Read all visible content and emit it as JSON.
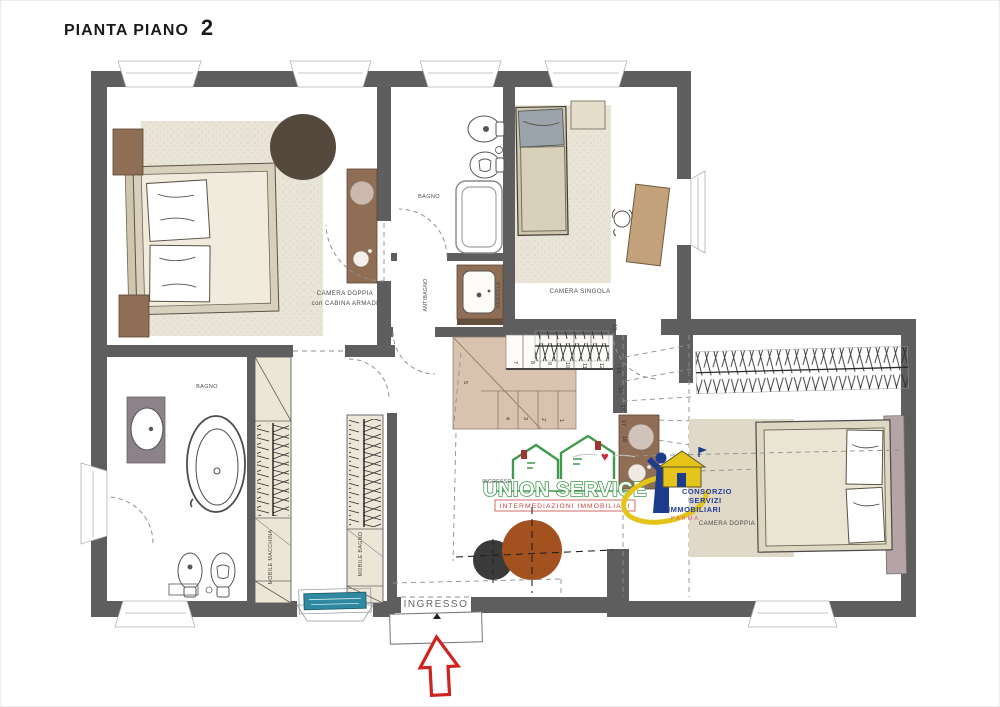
{
  "title": {
    "text": "PIANTA PIANO",
    "floor": "2"
  },
  "labels": {
    "camera_doppia_tl_1": "CAMERA DOPPIA",
    "camera_doppia_tl_2": "con CABINA ARMADI",
    "bagno_top": "BAGNO",
    "antibagno": "ANTIBAGNO",
    "mensola": "MENSOLA",
    "camera_singola": "CAMERA SINGOLA",
    "bagno_left": "BAGNO",
    "mobile_macchina": "MOBILE MACCHINA",
    "mobile_bagno": "MOBILE BAGNO",
    "ingresso_hall": "INGRESSO",
    "ingresso_entrance": "INGRESSO",
    "camera_doppia_right": "CAMERA DOPPIA"
  },
  "stairs": {
    "n1": "1",
    "n2": "2",
    "n3": "3",
    "n4": "4",
    "n5": "5",
    "n7": "7",
    "n8": "8",
    "n9": "9",
    "n10": "10",
    "n11": "11",
    "n12": "12",
    "n13": "13",
    "n14": "14",
    "n15": "15",
    "n16": "16",
    "n17": "17",
    "n18": "18"
  },
  "logos": {
    "union_service": {
      "name": "UNION SERVICE",
      "tagline": "INTERMEDIAZIONI IMMOBILIARI"
    },
    "consorzio": {
      "line1": "CONSORZIO",
      "line2": "SERVIZI",
      "line3": "IMMOBILIARI",
      "line4": "PARMA"
    }
  },
  "colors": {
    "wall": "#5e5e5e",
    "accent_red": "#cf231f",
    "teal": "#2f8aa1",
    "wood": "#8f6e55",
    "rust": "#a2511f",
    "union_green": "#3f9a4b",
    "union_red": "#c5473f",
    "consorzio_blue": "#27409b",
    "consorzio_yellow": "#e5c419"
  }
}
